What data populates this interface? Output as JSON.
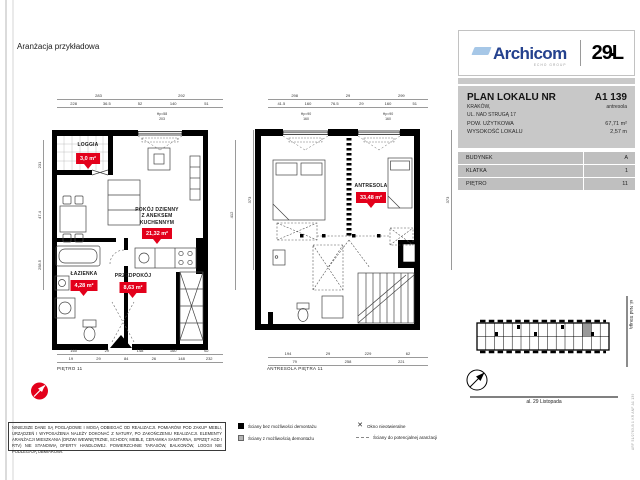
{
  "page": {
    "annotation": "Aranżacja przykładowa",
    "doc_code": "ARF 51/2763-B 1 KR ANF A1 139"
  },
  "brand": {
    "primary": "Archicom",
    "primary_sub": "ECHO GROUP",
    "secondary_digits": "29",
    "secondary_letter": "L"
  },
  "info_panel": {
    "title": "PLAN LOKALU NR",
    "unit": "A1 139",
    "unit_note": "antresola",
    "city": "KRAKÓW,",
    "street": "UL. NAD STRUGĄ 17",
    "area_label": "POW. UŻYTKOWA",
    "area_value": "67,71 m²",
    "height_label": "WYSOKOŚĆ LOKALU",
    "height_value": "2,57 m",
    "table": [
      {
        "label": "BUDYNEK",
        "value": "A"
      },
      {
        "label": "KLATKA",
        "value": "1"
      },
      {
        "label": "PIĘTRO",
        "value": "11"
      }
    ]
  },
  "site": {
    "street_right": "ul. Nad Strugą",
    "street_bottom": "al. 29 Listopada"
  },
  "plan_left": {
    "caption": "PIĘTRO 11",
    "rooms": {
      "loggia": {
        "name": "LOGGIA",
        "area": "3,0 m²"
      },
      "living": {
        "name": "POKÓJ DZIENNY Z ANEKSEM KUCHENNYM",
        "area": "21,32 m²"
      },
      "bath": {
        "name": "ŁAZIENKA",
        "area": "4,28 m²"
      },
      "hall": {
        "name": "PRZEDPOKÓJ",
        "area": "8,63 m²"
      }
    },
    "window_note": [
      "Hp=58",
      "203"
    ],
    "dims_top1": [
      "283",
      "292"
    ],
    "dims_top2": [
      "228",
      "36.5",
      "52",
      "140",
      "51"
    ],
    "dims_bottom1": [
      "160",
      "29",
      "148",
      "160",
      "62"
    ],
    "dims_bottom2": [
      "19",
      "29",
      "84",
      "26",
      "148",
      "232"
    ],
    "dims_left": [
      "258.5",
      "47.4",
      "231"
    ],
    "dims_right": [
      "412"
    ]
  },
  "plan_right": {
    "caption": "ANTRESOLA PIĘTRA 11",
    "rooms": {
      "antresola": {
        "name": "ANTRESOLA",
        "area": "33,48 m²"
      }
    },
    "window_note1": [
      "Hp=90",
      "160"
    ],
    "window_note2": [
      "Hp=90",
      "160"
    ],
    "dims_top1": [
      "298",
      "29",
      "299"
    ],
    "dims_top2": [
      "41.5",
      "160",
      "76.5",
      "29",
      "160",
      "51"
    ],
    "dims_bottom1": [
      "194",
      "29",
      "229",
      "62"
    ],
    "dims_bottom2": [
      "79",
      "258",
      "221"
    ],
    "dims_left": [
      "373"
    ],
    "dims_right": [
      "373"
    ]
  },
  "legend": {
    "wall_solid": "Ściany bez możliwości demontażu",
    "wall_removable": "Ściany z możliwością demontażu",
    "window_fixed": "Okno nieotwieralne",
    "wall_optional": "Ściany do potencjalnej aranżacji"
  },
  "disclaimer": "NINIEJSZE DANE SĄ POGLĄDOWE I MOGĄ ODBIEGAĆ OD REALIZACJI. POMIARÓW POD ZAKUP MEBLI, URZĄDZEŃ I WYPOSAŻENIA NALEŻY DOKONAĆ Z NATURY, PO ZAKOŃCZENIU REALIZACJI. ELEMENTY ARANŻACJI MIESZKANIA (DRZWI WEWNĘTRZNE, SCHODY, MEBLE, CERAMIKA SANITARNA, SPRZĘT AGD I RTV) NIE STANOWIĄ OFERTY HANDLOWEJ. POWIERZCHNIE TARASÓW, BALKONÓW, LOGGII NIE PODLEGAJĄ OBMIAROWI.",
  "colors": {
    "accent_red": "#e3001b",
    "panel_gray": "#c8c8c8",
    "logo_blue": "#24418e",
    "logo_flag_blue": "#a6c7e7"
  }
}
